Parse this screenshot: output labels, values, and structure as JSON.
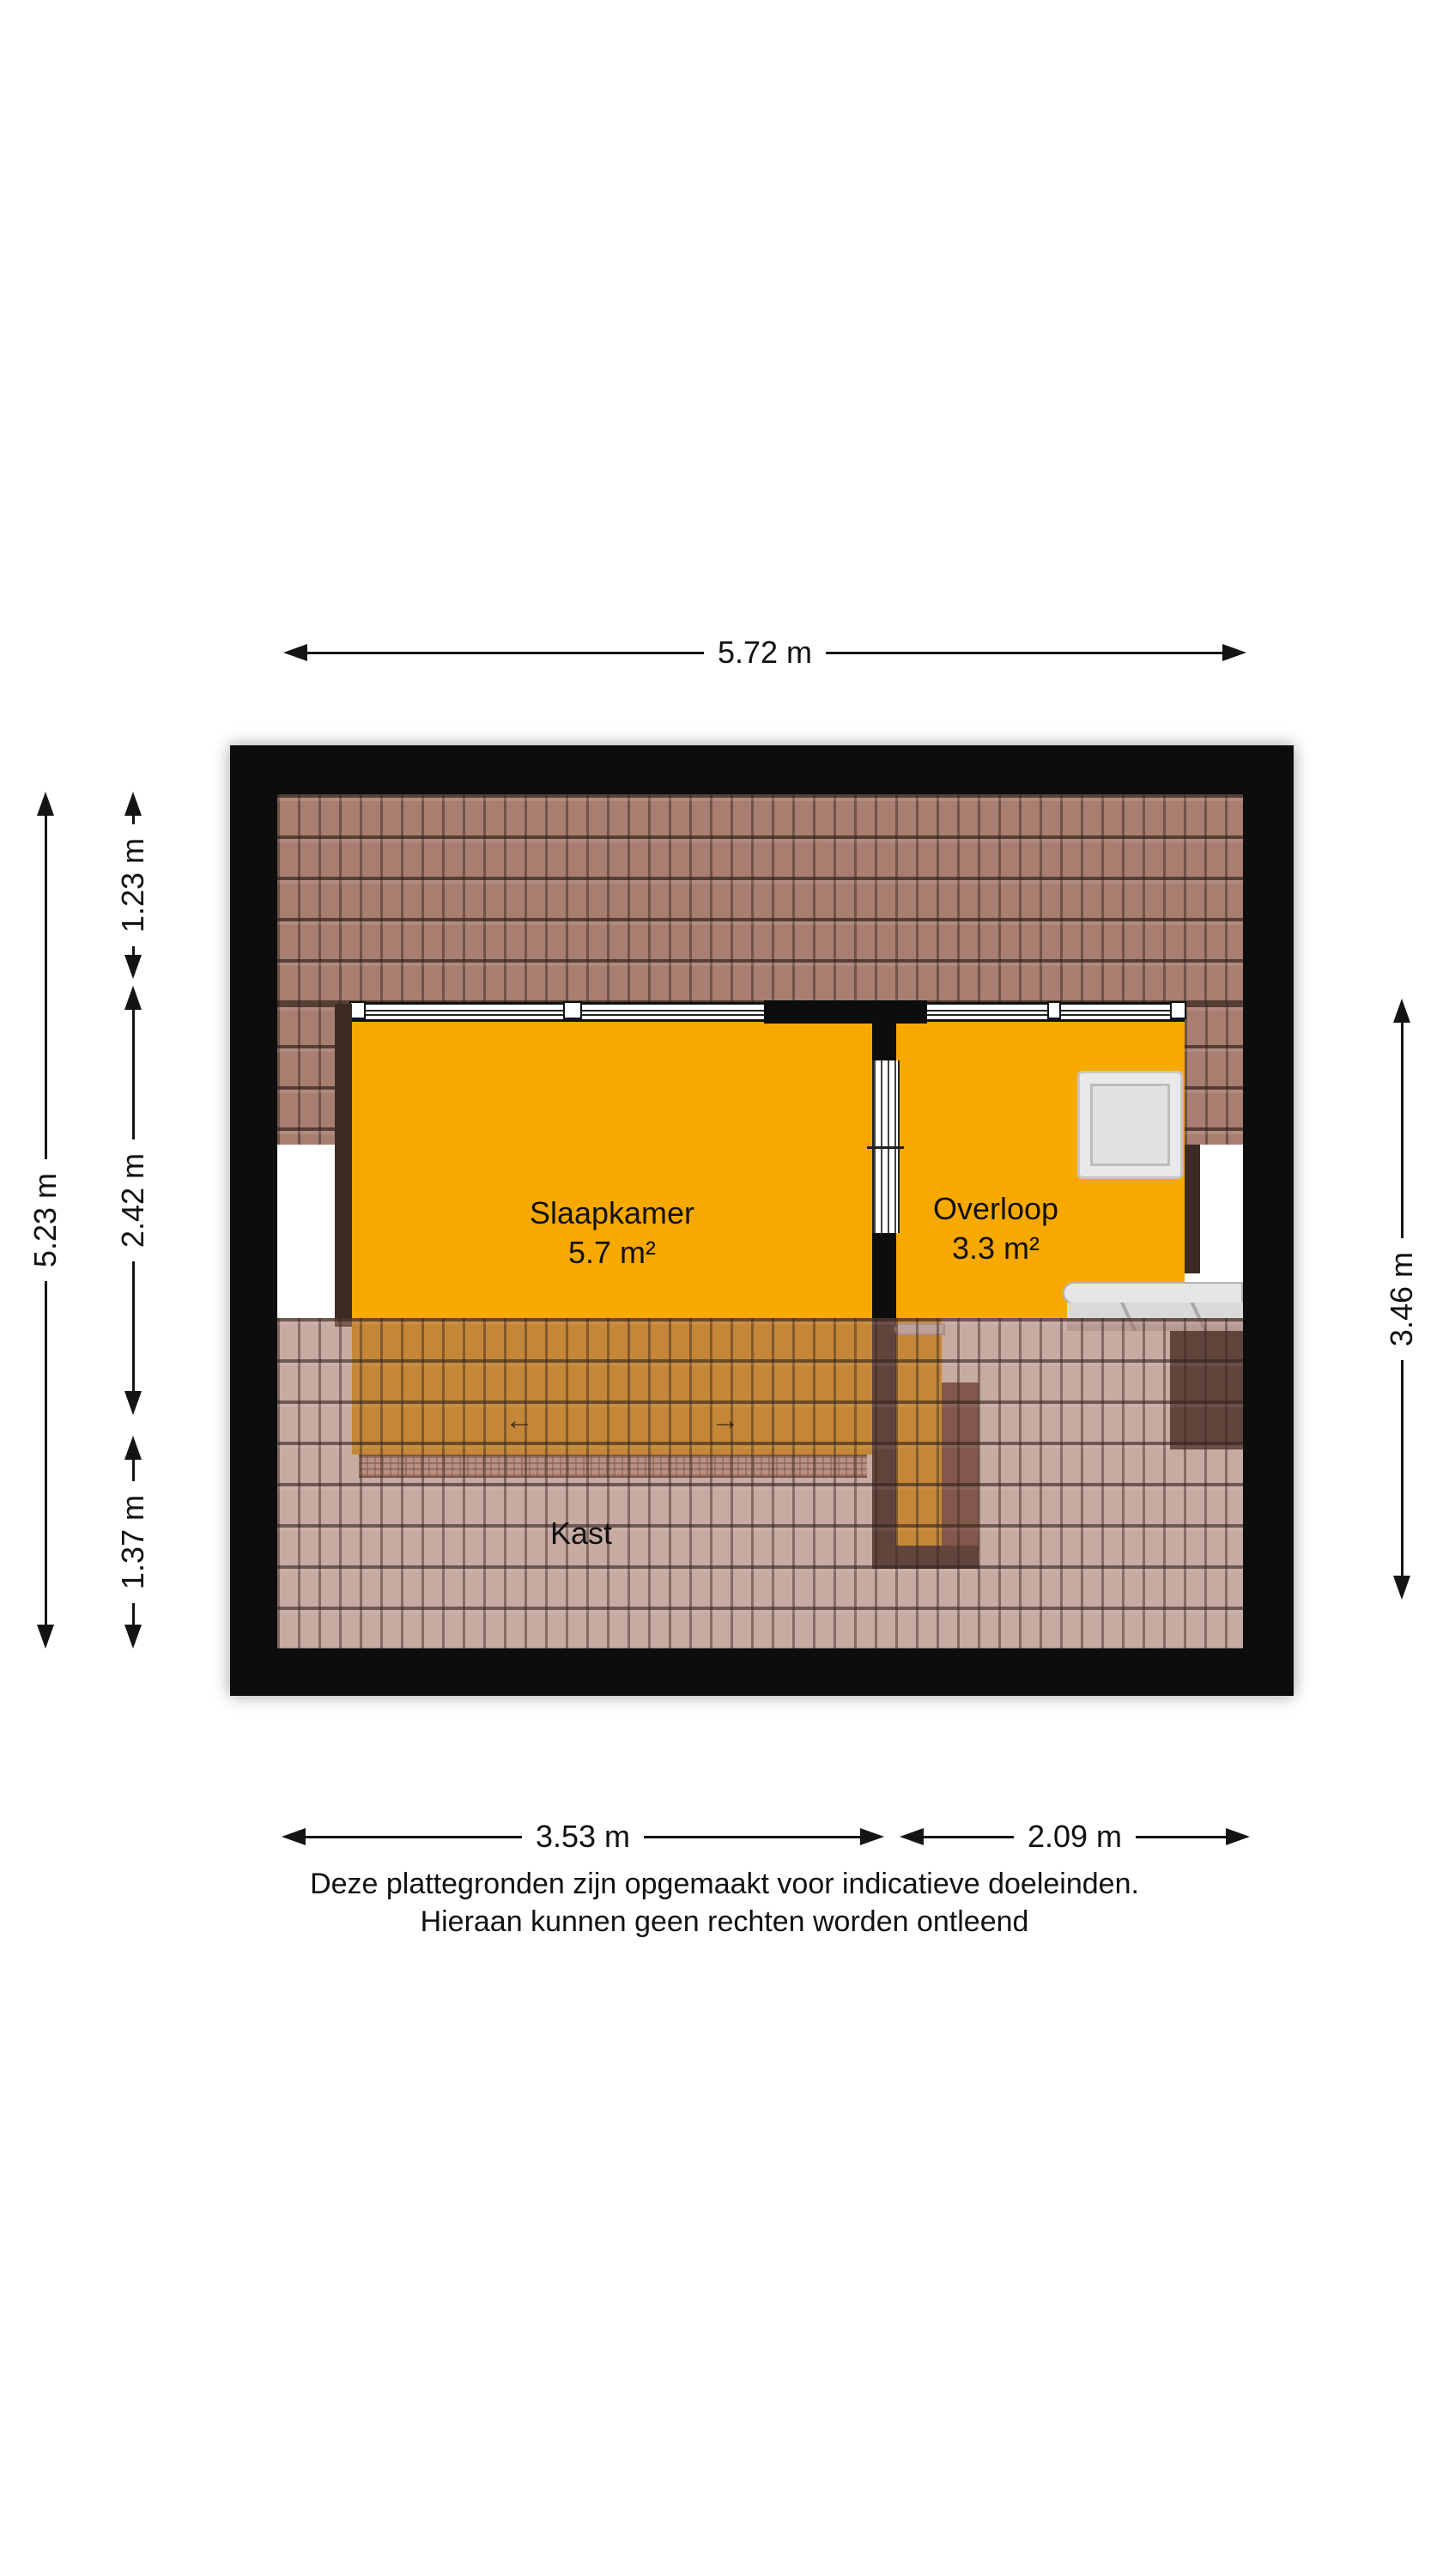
{
  "dimensions": {
    "top": "5.72 m",
    "left_total": "5.23 m",
    "left_segments": [
      "1.23 m",
      "2.42 m",
      "1.37 m"
    ],
    "right": "3.46 m",
    "bottom_left": "3.53 m",
    "bottom_right": "2.09 m"
  },
  "rooms": [
    {
      "name": "Slaapkamer",
      "area": "5.7 m²"
    },
    {
      "name": "Overloop",
      "area": "3.3 m²"
    },
    {
      "name": "Kast",
      "area": ""
    }
  ],
  "slide_arrows": {
    "left": "←",
    "right": "→"
  },
  "disclaimer": [
    "Deze plattegronden zijn opgemaakt voor indicatieve doeleinden.",
    "Hieraan kunnen geen rechten worden ontleend"
  ],
  "colors": {
    "floor_orange": "#f8a900",
    "wall_black": "#0d0d0d",
    "roof_tile": "#a87e70"
  }
}
